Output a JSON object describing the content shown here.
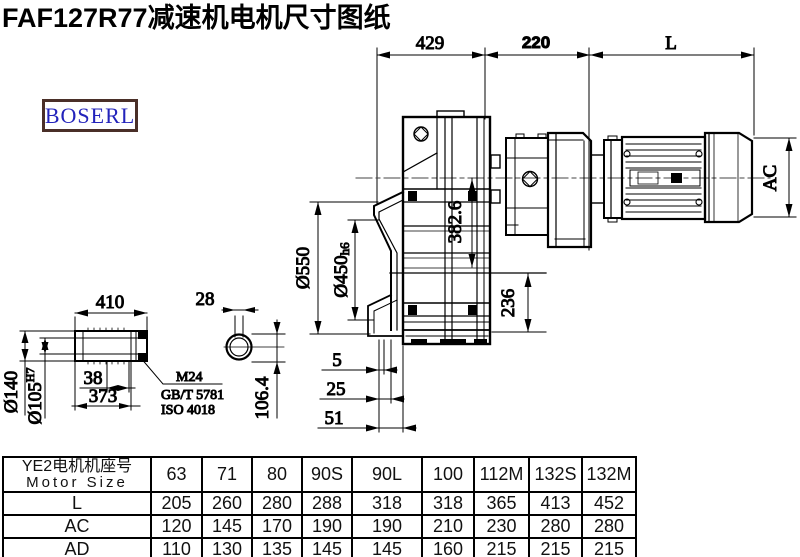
{
  "title": "FAF127R77减速机电机尺寸图纸",
  "logo": {
    "text": "BOSERL"
  },
  "colors": {
    "logo_text": "#2323bb",
    "logo_border": "#4a2f28",
    "line": "#000000"
  },
  "drawing": {
    "top_dims": {
      "d429": "429",
      "d220": "220",
      "dL": "L"
    },
    "main_dims": {
      "d550": "Ø550",
      "d450": "Ø450",
      "d450_suffix": "h6",
      "v3826": "382.6",
      "v236": "236",
      "s5": "5",
      "s25": "25",
      "s51": "51",
      "ac": "AC"
    },
    "shaft_dims": {
      "d410": "410",
      "d28": "28",
      "d140": "Ø140",
      "d105": "Ø105",
      "d105_sup": "H7",
      "d38": "38",
      "d373": "373",
      "d1064": "106.4",
      "note1": "M24",
      "note2": "GB/T 5781",
      "note3": "ISO 4018"
    }
  },
  "table": {
    "header_cn": "YE2电机机座号",
    "header_en": "Motor Size",
    "columns": [
      "63",
      "71",
      "80",
      "90S",
      "90L",
      "100",
      "112M",
      "132S",
      "132M"
    ],
    "rows": [
      {
        "label": "L",
        "values": [
          "205",
          "260",
          "280",
          "288",
          "318",
          "318",
          "365",
          "413",
          "452"
        ]
      },
      {
        "label": "AC",
        "values": [
          "120",
          "145",
          "170",
          "190",
          "190",
          "210",
          "230",
          "280",
          "280"
        ]
      },
      {
        "label": "AD",
        "values": [
          "110",
          "130",
          "135",
          "145",
          "145",
          "160",
          "215",
          "215",
          "215"
        ]
      }
    ]
  }
}
